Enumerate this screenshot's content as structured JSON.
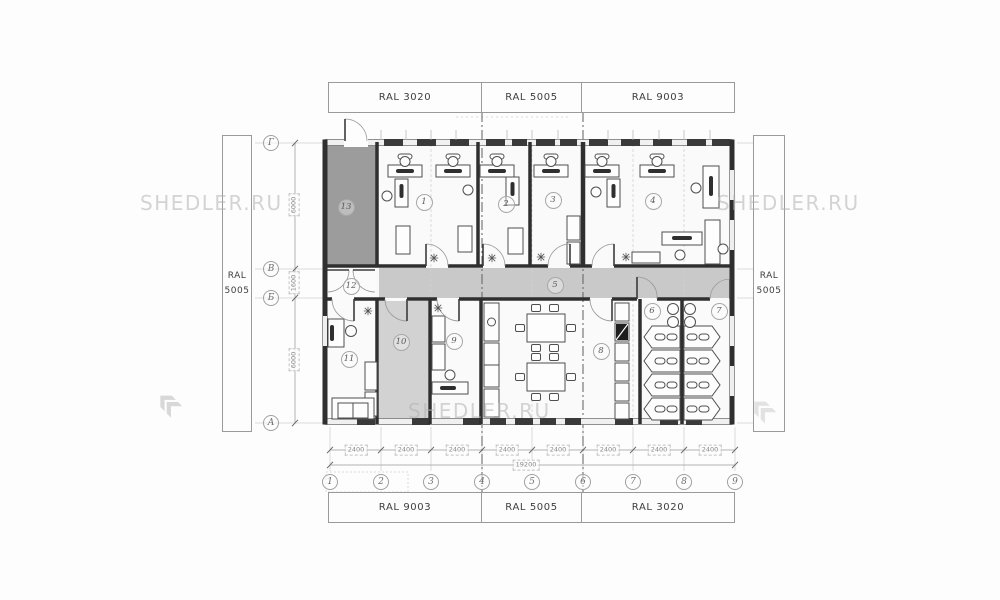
{
  "watermark": {
    "instances": [
      {
        "text": "SHEDLER.RU",
        "x": 140,
        "y": 191
      },
      {
        "text": "SHEDLER.RU",
        "x": 717,
        "y": 191
      },
      {
        "text": "SHEDLER.RU",
        "x": 408,
        "y": 399
      }
    ]
  },
  "bands": {
    "top": [
      "RAL 3020",
      "RAL 5005",
      "RAL 9003"
    ],
    "bottom": [
      "RAL 9003",
      "RAL 5005",
      "RAL 3020"
    ]
  },
  "side_labels": {
    "left": {
      "line1": "RAL",
      "line2": "5005"
    },
    "right": {
      "line1": "RAL",
      "line2": "5005"
    }
  },
  "grid": {
    "columns": [
      {
        "label": "1",
        "x": 330,
        "y": 482
      },
      {
        "label": "2",
        "x": 381,
        "y": 482
      },
      {
        "label": "3",
        "x": 431,
        "y": 482
      },
      {
        "label": "4",
        "x": 482,
        "y": 482
      },
      {
        "label": "5",
        "x": 532,
        "y": 482
      },
      {
        "label": "6",
        "x": 583,
        "y": 482
      },
      {
        "label": "7",
        "x": 633,
        "y": 482
      },
      {
        "label": "8",
        "x": 684,
        "y": 482
      },
      {
        "label": "9",
        "x": 735,
        "y": 482
      }
    ],
    "rows": [
      {
        "label": "Г",
        "x": 271,
        "y": 143
      },
      {
        "label": "В",
        "x": 271,
        "y": 269
      },
      {
        "label": "Б",
        "x": 271,
        "y": 298
      },
      {
        "label": "А",
        "x": 271,
        "y": 423
      }
    ]
  },
  "rooms": [
    {
      "number": "1",
      "x": 424,
      "y": 202
    },
    {
      "number": "2",
      "x": 506,
      "y": 204
    },
    {
      "number": "3",
      "x": 553,
      "y": 200
    },
    {
      "number": "4",
      "x": 653,
      "y": 201
    },
    {
      "number": "5",
      "x": 555,
      "y": 285
    },
    {
      "number": "6",
      "x": 652,
      "y": 311
    },
    {
      "number": "7",
      "x": 719,
      "y": 311
    },
    {
      "number": "8",
      "x": 601,
      "y": 351
    },
    {
      "number": "9",
      "x": 454,
      "y": 341
    },
    {
      "number": "10",
      "x": 401,
      "y": 342
    },
    {
      "number": "11",
      "x": 349,
      "y": 359
    },
    {
      "number": "12",
      "x": 351,
      "y": 286
    },
    {
      "number": "13",
      "x": 346,
      "y": 207
    }
  ],
  "dimensions": {
    "bays": [
      {
        "label": "2400",
        "x": 356,
        "y": 450
      },
      {
        "label": "2400",
        "x": 406,
        "y": 450
      },
      {
        "label": "2400",
        "x": 457,
        "y": 450
      },
      {
        "label": "2400",
        "x": 507,
        "y": 450
      },
      {
        "label": "2400",
        "x": 558,
        "y": 450
      },
      {
        "label": "2400",
        "x": 608,
        "y": 450
      },
      {
        "label": "2400",
        "x": 659,
        "y": 450
      },
      {
        "label": "2400",
        "x": 710,
        "y": 450
      }
    ],
    "total": {
      "label": "19200",
      "x": 526,
      "y": 465
    },
    "left": [
      {
        "label": "6000",
        "x": 294,
        "y": 205
      },
      {
        "label": "1600",
        "x": 294,
        "y": 283
      },
      {
        "label": "6000",
        "x": 294,
        "y": 360
      }
    ]
  },
  "colors": {
    "wall": "#2f2f2f",
    "corridor_fill": "#c9c9c9",
    "room13_fill": "#9c9c9c",
    "room10_fill": "#d2d2d2",
    "watermark": "#c9c9c9"
  }
}
